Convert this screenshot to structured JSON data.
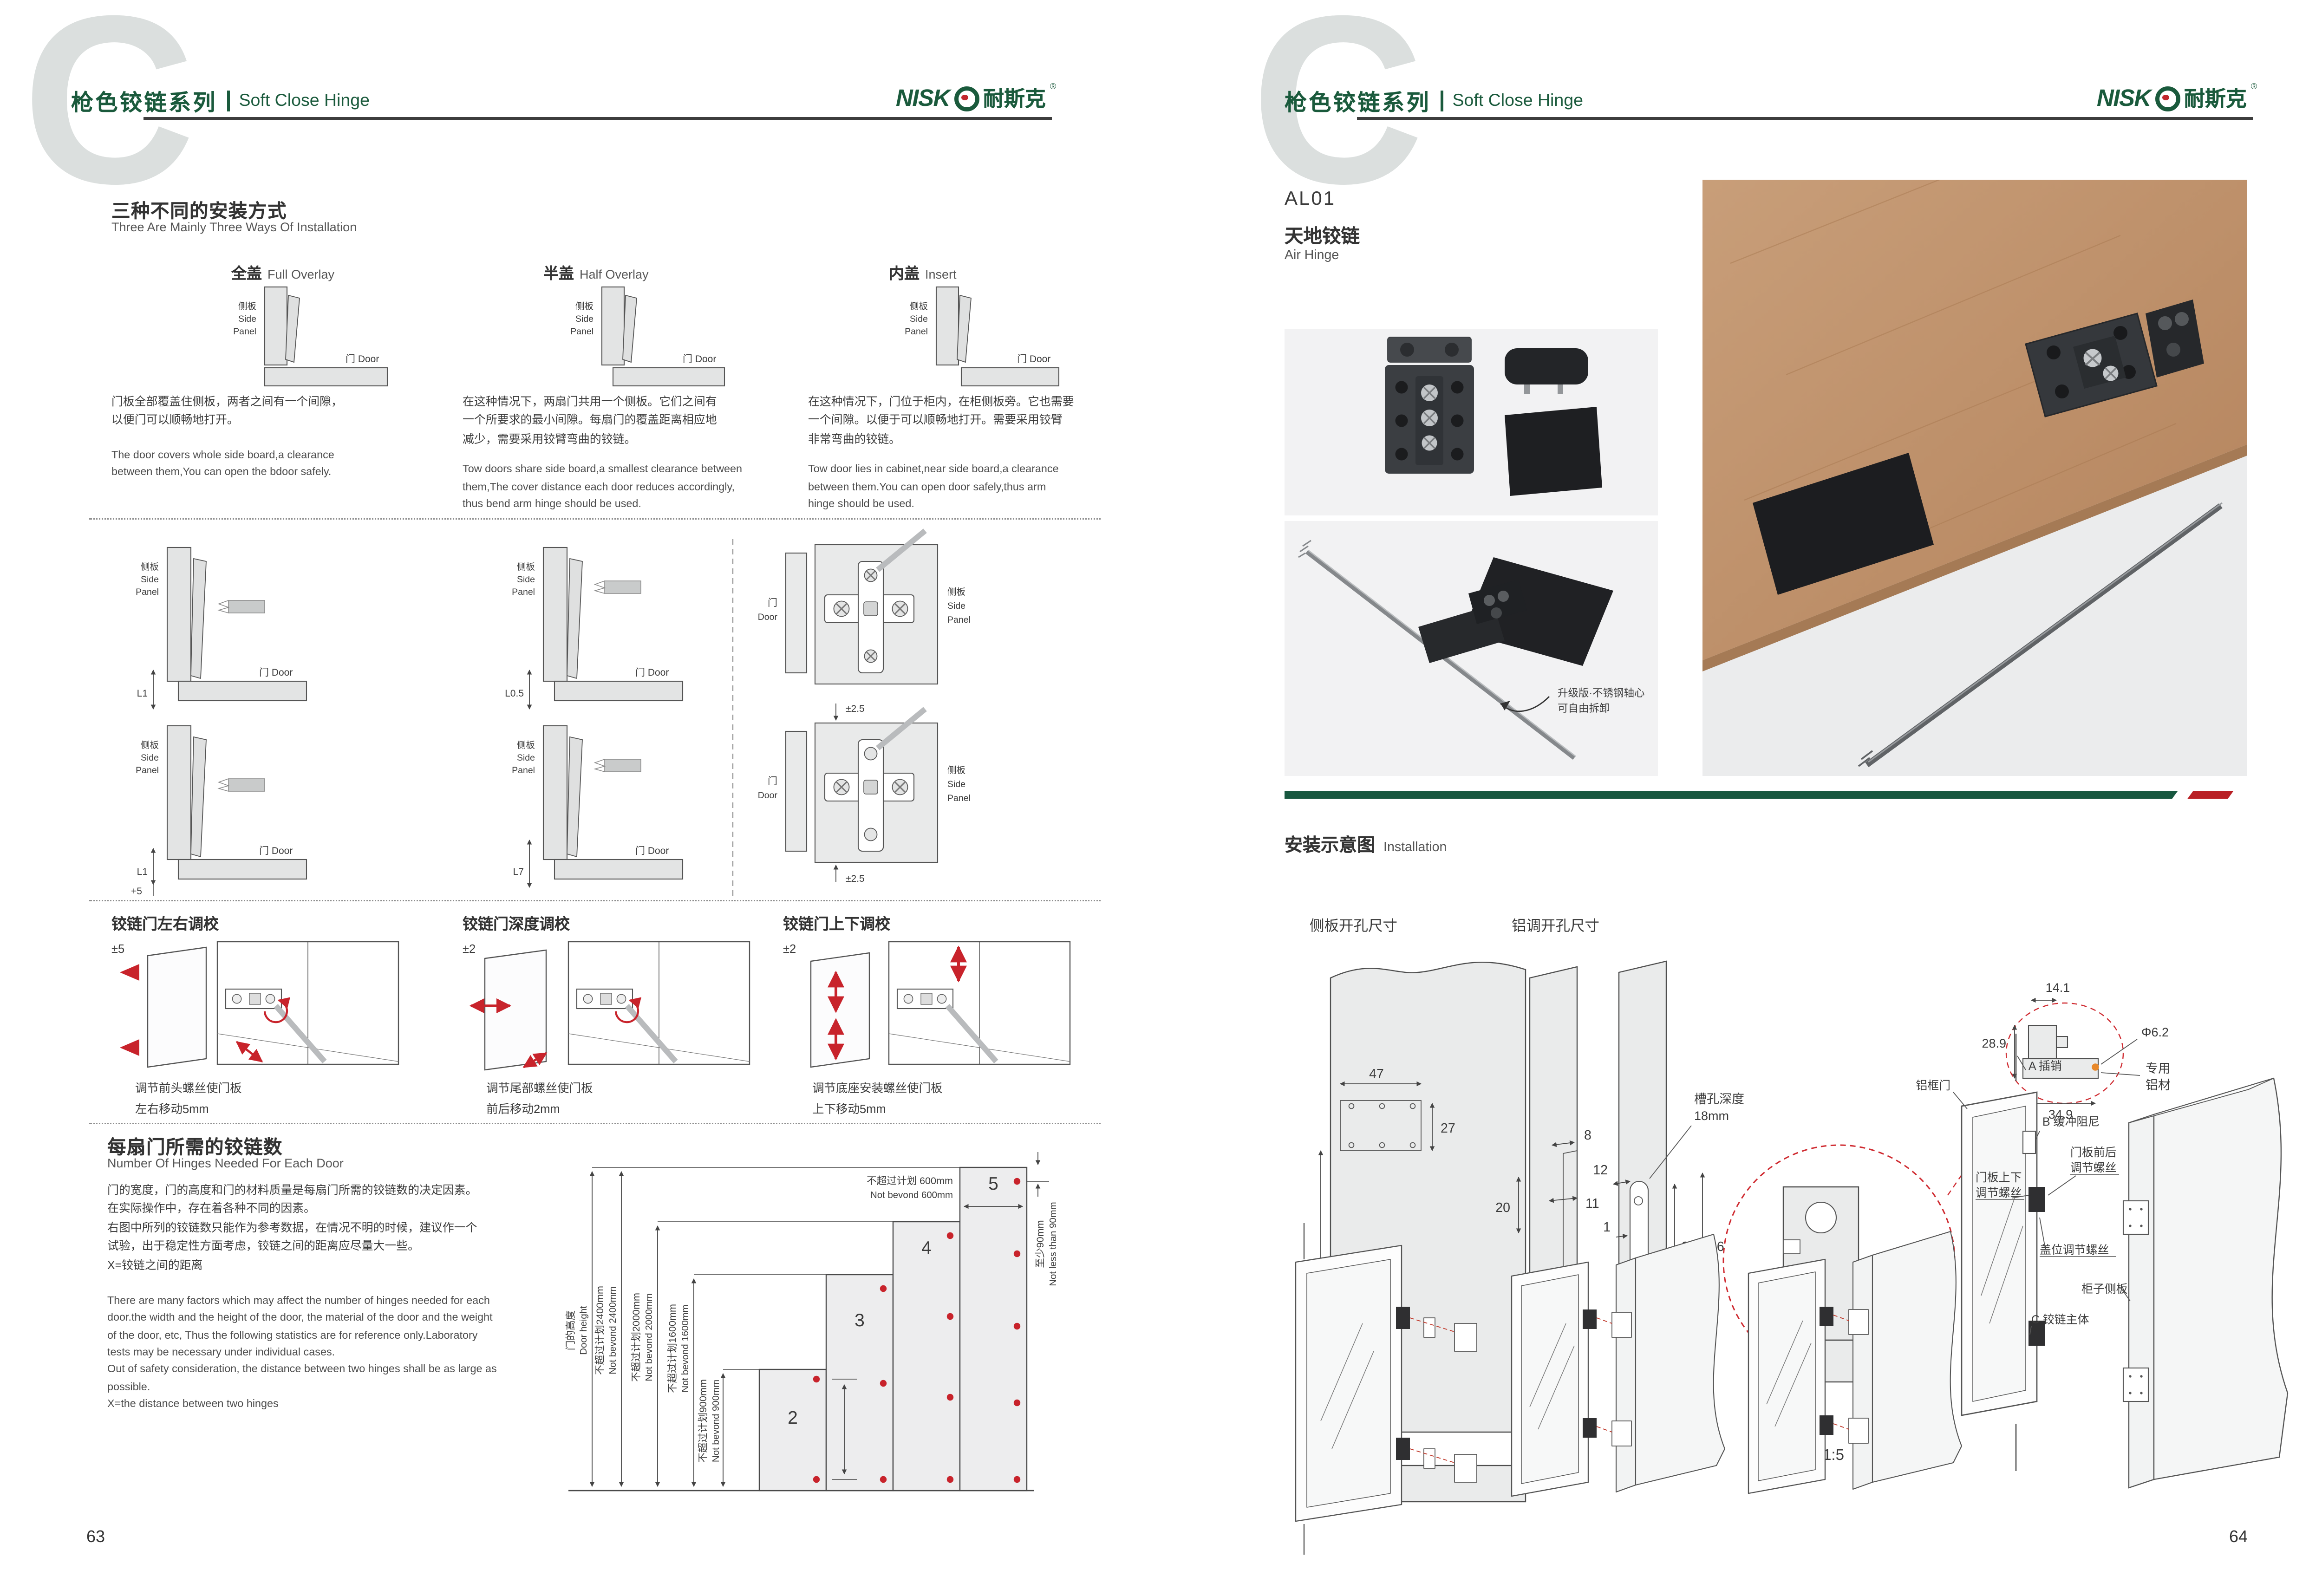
{
  "watermark": "C",
  "header": {
    "series_zh": "枪色铰链系列",
    "series_en": "Soft Close Hinge"
  },
  "logo": {
    "latin": "NISK",
    "zh": "耐斯克",
    "reg": "®"
  },
  "page_numbers": {
    "left": "63",
    "right": "64"
  },
  "install_types": {
    "heading_zh": "三种不同的安装方式",
    "heading_en": "Three Are Mainly Three Ways Of Installation",
    "side_l1": "侧板",
    "side_l2": "Side",
    "side_l3": "Panel",
    "door_label": "门 Door",
    "types": [
      {
        "name_zh": "全盖",
        "name_en": "Full Overlay",
        "desc_zh": "门板全部覆盖住侧板，两者之间有一个间隙，\n以便门可以顺畅地打开。",
        "desc_en": "The door covers whole side board,a clearance\nbetween them,You can open the bdoor safely."
      },
      {
        "name_zh": "半盖",
        "name_en": "Half Overlay",
        "desc_zh": "在这种情况下，两扇门共用一个侧板。它们之间有\n一个所要求的最小间隙。每扇门的覆盖距离相应地\n减少，需要采用铰臂弯曲的铰链。",
        "desc_en": "Tow doors share side board,a smallest clearance between\nthem,The cover distance each door reduces accordingly,\nthus bend arm hinge should be used."
      },
      {
        "name_zh": "内盖",
        "name_en": "Insert",
        "desc_zh": "在这种情况下，门位于柜内，在柜侧板旁。它也需要\n一个间隙。以便于可以顺畅地打开。需要采用铰臂\n非常弯曲的铰链。",
        "desc_en": "Tow door lies in cabinet,near side board,a clearance\nbetween them.You can open door safely,thus arm\nhinge should be used."
      }
    ],
    "dims": {
      "r1c1": "L1",
      "r1c2": "L0.5",
      "r2c1": "L1",
      "r2c1b": "+5",
      "r2c2": "L7",
      "plate_top": "±2.5",
      "plate_bottom": "±2.5"
    }
  },
  "adjust": {
    "items": [
      {
        "title": "铰链门左右调校",
        "tol": "±5",
        "note": "调节前头螺丝使门板\n左右移动5mm"
      },
      {
        "title": "铰链门深度调校",
        "tol": "±2",
        "note": "调节尾部螺丝使门板\n前后移动2mm"
      },
      {
        "title": "铰链门上下调校",
        "tol": "±2",
        "note": "调节底座安装螺丝使门板\n上下移动5mm"
      }
    ]
  },
  "hinge_count": {
    "heading_zh": "每扇门所需的铰链数",
    "heading_en": "Number Of Hinges Needed For Each Door",
    "para_zh": "门的宽度，门的高度和门的材料质量是每扇门所需的铰链数的决定因素。\n在实际操作中，存在着各种不同的因素。\n右图中所列的铰链数只能作为参考数据，在情况不明的时候，建议作一个\n试验，出于稳定性方面考虑，铰链之间的距离应尽量大一些。\nX=铰链之间的距离",
    "para_en": "There are many factors which may affect the number of hinges needed for each\ndoor.the width and the height of the door, the material of the door and the weight\nof the door, etc, Thus the following statistics are for reference only.Laboratory\ntests may be necessary under individual cases.\nOut of safety consideration, the distance between two hinges shall be as large as\npossible.\nX=the distance between two hinges"
  },
  "chart_data": {
    "type": "bar",
    "title": "每扇门所需的铰链数 Number Of Hinges Needed For Each Door",
    "categories": [
      "2",
      "3",
      "4",
      "5"
    ],
    "values": [
      900,
      1600,
      2000,
      2400
    ],
    "ylabel": "门的高度 Door height (mm)",
    "xlabel": "铰链数 hinges per door",
    "ylim": [
      0,
      2400
    ],
    "door_width_max_mm": 600,
    "hinge_edge_min_mm": 90,
    "labels": {
      "door_height_zh": "门的高度",
      "door_height_en": "Door height",
      "h2400_zh": "不超过计划2400mm",
      "h2400_en": "Not bevond 2400mm",
      "h2000_zh": "不超过计划2000mm",
      "h2000_en": "Not bevond 2000mm",
      "h1600_zh": "不超过计划1600mm",
      "h1600_en": "Not bevond 1600mm",
      "h900_zh": "不超过计划900mm",
      "h900_en": "Not bevond 900mm",
      "w600_zh": "不超过计划 600mm",
      "w600_en": "Not bevond 600mm",
      "e90_zh": "至少90mm",
      "e90_en": "Not less than 90mm"
    }
  },
  "product": {
    "code": "AL01",
    "name_zh": "天地铰链",
    "name_en": "Air Hinge"
  },
  "photos": {
    "upgrade_l1": "升级版·不锈钢轴心",
    "upgrade_l2": "可自由拆卸"
  },
  "installation": {
    "heading_zh": "安装示意图",
    "heading_en": "Installation",
    "side_drill": {
      "title": "侧板开孔尺寸",
      "d47": "47",
      "d27": "27",
      "d77": "77",
      "d25": "25"
    },
    "alu_drill": {
      "title": "铝调开孔尺寸",
      "d8": "8",
      "d20": "20",
      "d11": "11",
      "d12": "12",
      "d1": "1",
      "d33": "33",
      "d46": "46",
      "d155": "15.5",
      "m5": "M5",
      "slot_l1": "槽孔深度",
      "slot_l2": "18mm"
    },
    "detail": {
      "scale": "1:5",
      "m5": "M5",
      "d141": "14.1",
      "d289": "28.9",
      "d62": "Φ6.2",
      "d349": "34.9",
      "alu_l1": "专用",
      "alu_l2": "铝材"
    },
    "exploded": {
      "alu_door": "铝框门",
      "a_pin": "A 插销",
      "b_damper": "B 缓冲阻尼",
      "fb_l1": "门板前后",
      "fb_l2": "调节螺丝",
      "ud_l1": "门板上下",
      "ud_l2": "调节螺丝",
      "cover": "盖位调节螺丝",
      "cabinet": "柜子侧板",
      "c_body": "C 铰链主体"
    }
  },
  "colors": {
    "brand_green": "#1a5a3c",
    "accent_red": "#c2272d",
    "band_green": "#17573f",
    "band_red": "#b92025"
  }
}
